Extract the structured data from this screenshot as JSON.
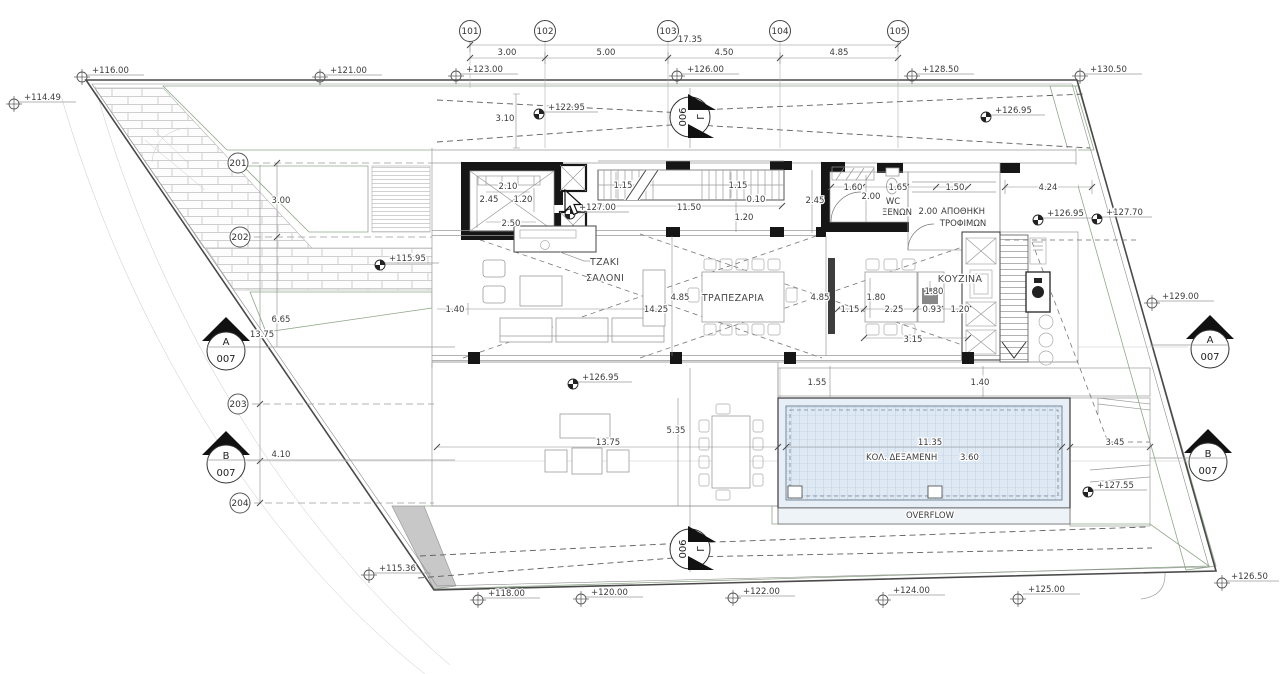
{
  "drawing": {
    "grid_top": [
      "101",
      "102",
      "103",
      "104",
      "105"
    ],
    "grid_left": [
      "201",
      "202",
      "203",
      "204"
    ],
    "top_dims": {
      "overall": "17.35",
      "d1": "3.00",
      "d2": "5.00",
      "d3": "4.50",
      "d4": "4.85"
    },
    "sections": {
      "a": "A",
      "b": "B",
      "gamma": "Γ",
      "sheet_ab": "007",
      "sheet_gamma": "006"
    },
    "levels": {
      "site": [
        "+114.49",
        "+116.00",
        "+121.00",
        "+123.00",
        "+126.00",
        "+128.50",
        "+130.50",
        "+115.36",
        "+118.00",
        "+120.00",
        "+122.00",
        "+124.00",
        "+125.00",
        "+126.50",
        "+129.00"
      ],
      "spot": [
        "+122.95",
        "+115.95",
        "+127.00",
        "+126.95",
        "+126.95",
        "+127.70",
        "+126.95",
        "+127.55"
      ]
    },
    "rooms": {
      "fireplace": "ΤΖΑΚΙ",
      "living": "ΣΑΛΟΝΙ",
      "dining": "ΤΡΑΠΕΖΑΡΙΑ",
      "kitchen": "ΚΟΥΖΙΝΑ",
      "wc1": "WC",
      "wc2": "ΞΕΝΩΝ",
      "pantry1": "ΑΠΟΘΗΚΗ",
      "pantry2": "ΤΡΟΦΙΜΩΝ",
      "pool": "ΚΟΛ. ΔΕΞΑΜΕΝΗ",
      "pool_depth": "3.60",
      "overflow": "OVERFLOW"
    },
    "dims": {
      "path": "3.10",
      "elev_top": "2.10",
      "elev_left": "2.45",
      "elev_right": "1.20",
      "elev_bottom": "2.50",
      "stair_w1": "1.15",
      "stair_w2": "1.15",
      "stair_gap": "0.10",
      "stair_len": "11.50",
      "stair_off": "1.20",
      "wc_w": "1.60",
      "wc_h": "2.00",
      "wc_d": "1.65",
      "store_w": "1.50",
      "store_h": "2.00",
      "hall_w": "2.45",
      "side_yard": "4.24",
      "living_off": "1.40",
      "living_d": "4.85",
      "living_len": "14.25",
      "dining_d": "4.85",
      "kit_a": "1.80",
      "kit_b": "1.80",
      "kit_c": "1.15",
      "kit_d": "2.25",
      "kit_e": "0.93",
      "kit_f": "1.20",
      "kit_total": "3.15",
      "deck_a": "1.55",
      "deck_b": "1.40",
      "deck_d": "5.35",
      "deck_len": "13.75",
      "pool_len": "11.35",
      "pool_deck": "3.45",
      "left_a": "3.00",
      "left_b": "6.65",
      "left_c": "13.75",
      "left_d": "4.10"
    }
  }
}
